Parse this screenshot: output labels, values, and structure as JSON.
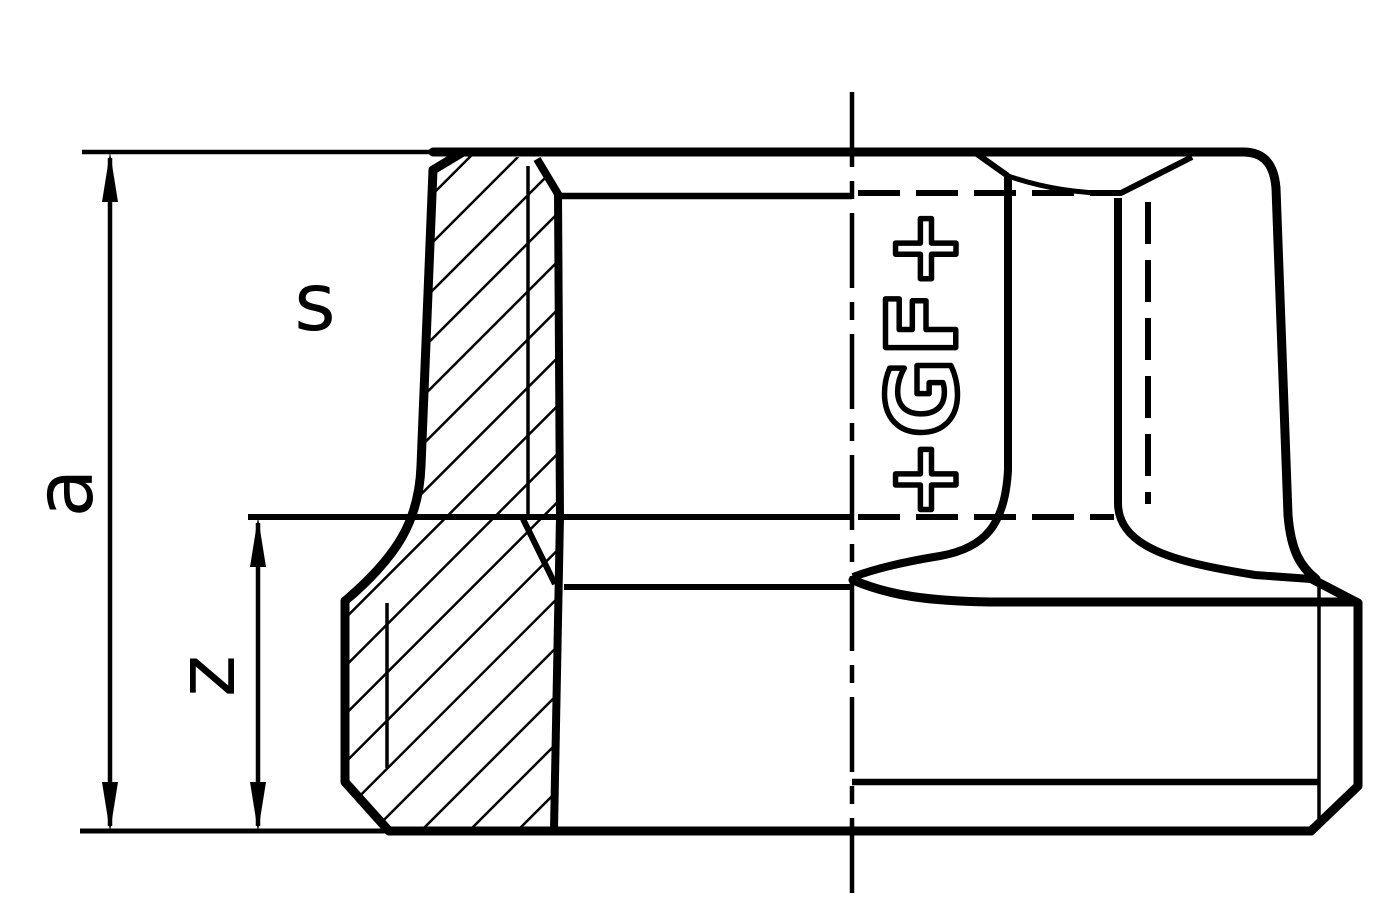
{
  "drawing": {
    "description": "Half-section technical drawing of a threaded pipe fitting socket",
    "labels": {
      "a": "a",
      "s": "s",
      "z": "z"
    },
    "logo": {
      "text": "+GF+"
    },
    "colors": {
      "line": "#000000",
      "background": "#ffffff"
    }
  }
}
